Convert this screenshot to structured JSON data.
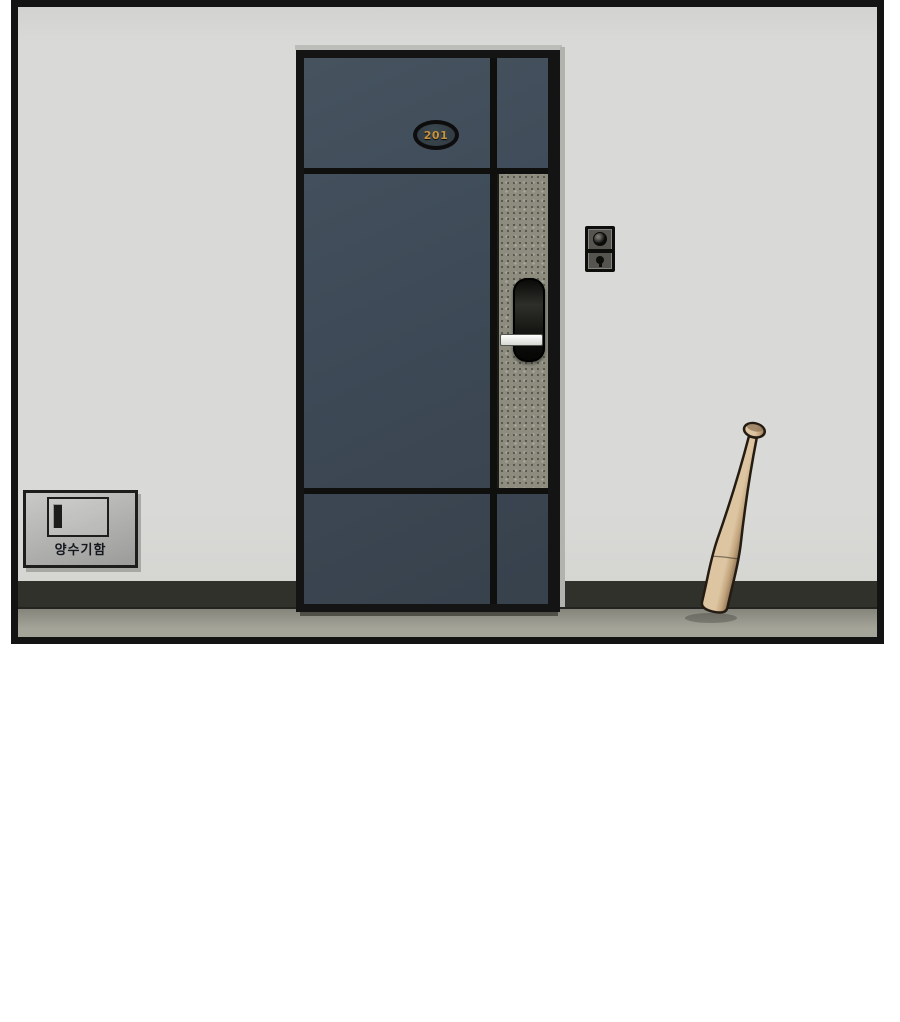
{
  "scene": {
    "type": "webtoon-panel-illustration",
    "description": "Apartment hallway: dark blue front door numbered 201 with digital lock, video doorbell on the wall, metal water-meter box on the left wall, wooden baseball bat leaning upside-down against the right wall",
    "door_plate": {
      "number": "201"
    },
    "meter_box": {
      "label": "양수기함"
    }
  },
  "colors": {
    "background": "#ffffff",
    "panel_border": "#131313",
    "wall": "#d9d9d7",
    "baseboard": "#31312c",
    "floor_top": "#85857b",
    "floor_bottom": "#a4a499",
    "door_frame": "#141414",
    "door_leaf": "#3e4a57",
    "door_strip": "#8d8c7f",
    "divider": "#0f0f0d",
    "plate_ring": "#0d0d0d",
    "plate_face": "#333d45",
    "plate_text": "#c8913c",
    "lock_handle": "#efefec",
    "doorbell_body": "#55544f",
    "doorbell_dark": "#0d0d0b",
    "box_face": "#b6b6b4",
    "box_border": "#1d1d1b",
    "box_label": "#14181e",
    "bat_light": "#ddc5a2",
    "bat_mid": "#c2a47c",
    "bat_dark": "#8a7154",
    "bat_outline": "#241c12"
  }
}
